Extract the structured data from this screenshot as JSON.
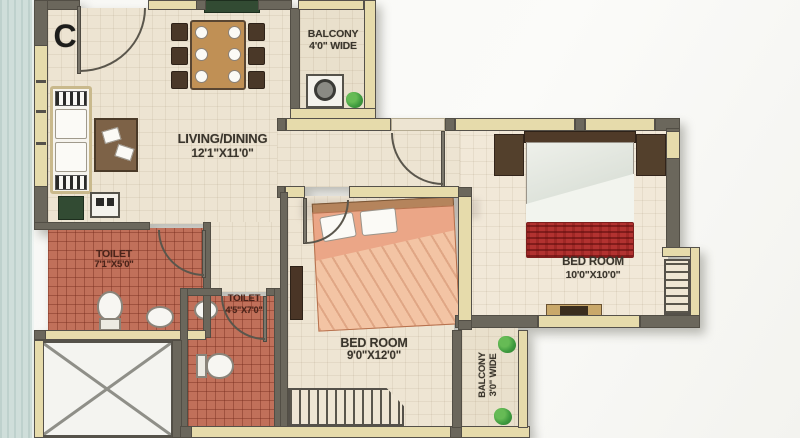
{
  "plan": {
    "unit_label": "C",
    "rooms": {
      "living_dining": {
        "name": "LIVING/DINING",
        "dims": "12'1\"X11'0\""
      },
      "balcony_top": {
        "name": "BALCONY",
        "dims": "4'0\" WIDE"
      },
      "toilet_1": {
        "name": "TOILET",
        "dims": "7'1\"X5'0\""
      },
      "toilet_2": {
        "name": "TOILET",
        "dims": "4'5\"X7'0\""
      },
      "bedroom_1": {
        "name": "BED ROOM",
        "dims": "9'0\"X12'0\""
      },
      "bedroom_2": {
        "name": "BED ROOM",
        "dims": "10'0\"X10'0\""
      },
      "balcony_right": {
        "name": "BALCONY",
        "dims": "3'0\" WIDE"
      }
    },
    "colors": {
      "wall_dark": "#6b675c",
      "wall_trim_beige": "#e6dbab",
      "floor_cream": "#ede4d2",
      "toilet_floor_brick": "#c1705a",
      "bed_blanket_red": "#b23230",
      "bed_orange": "#eba687",
      "plant_green": "#3f9b3f",
      "background_strip": "#cfdeda"
    }
  }
}
